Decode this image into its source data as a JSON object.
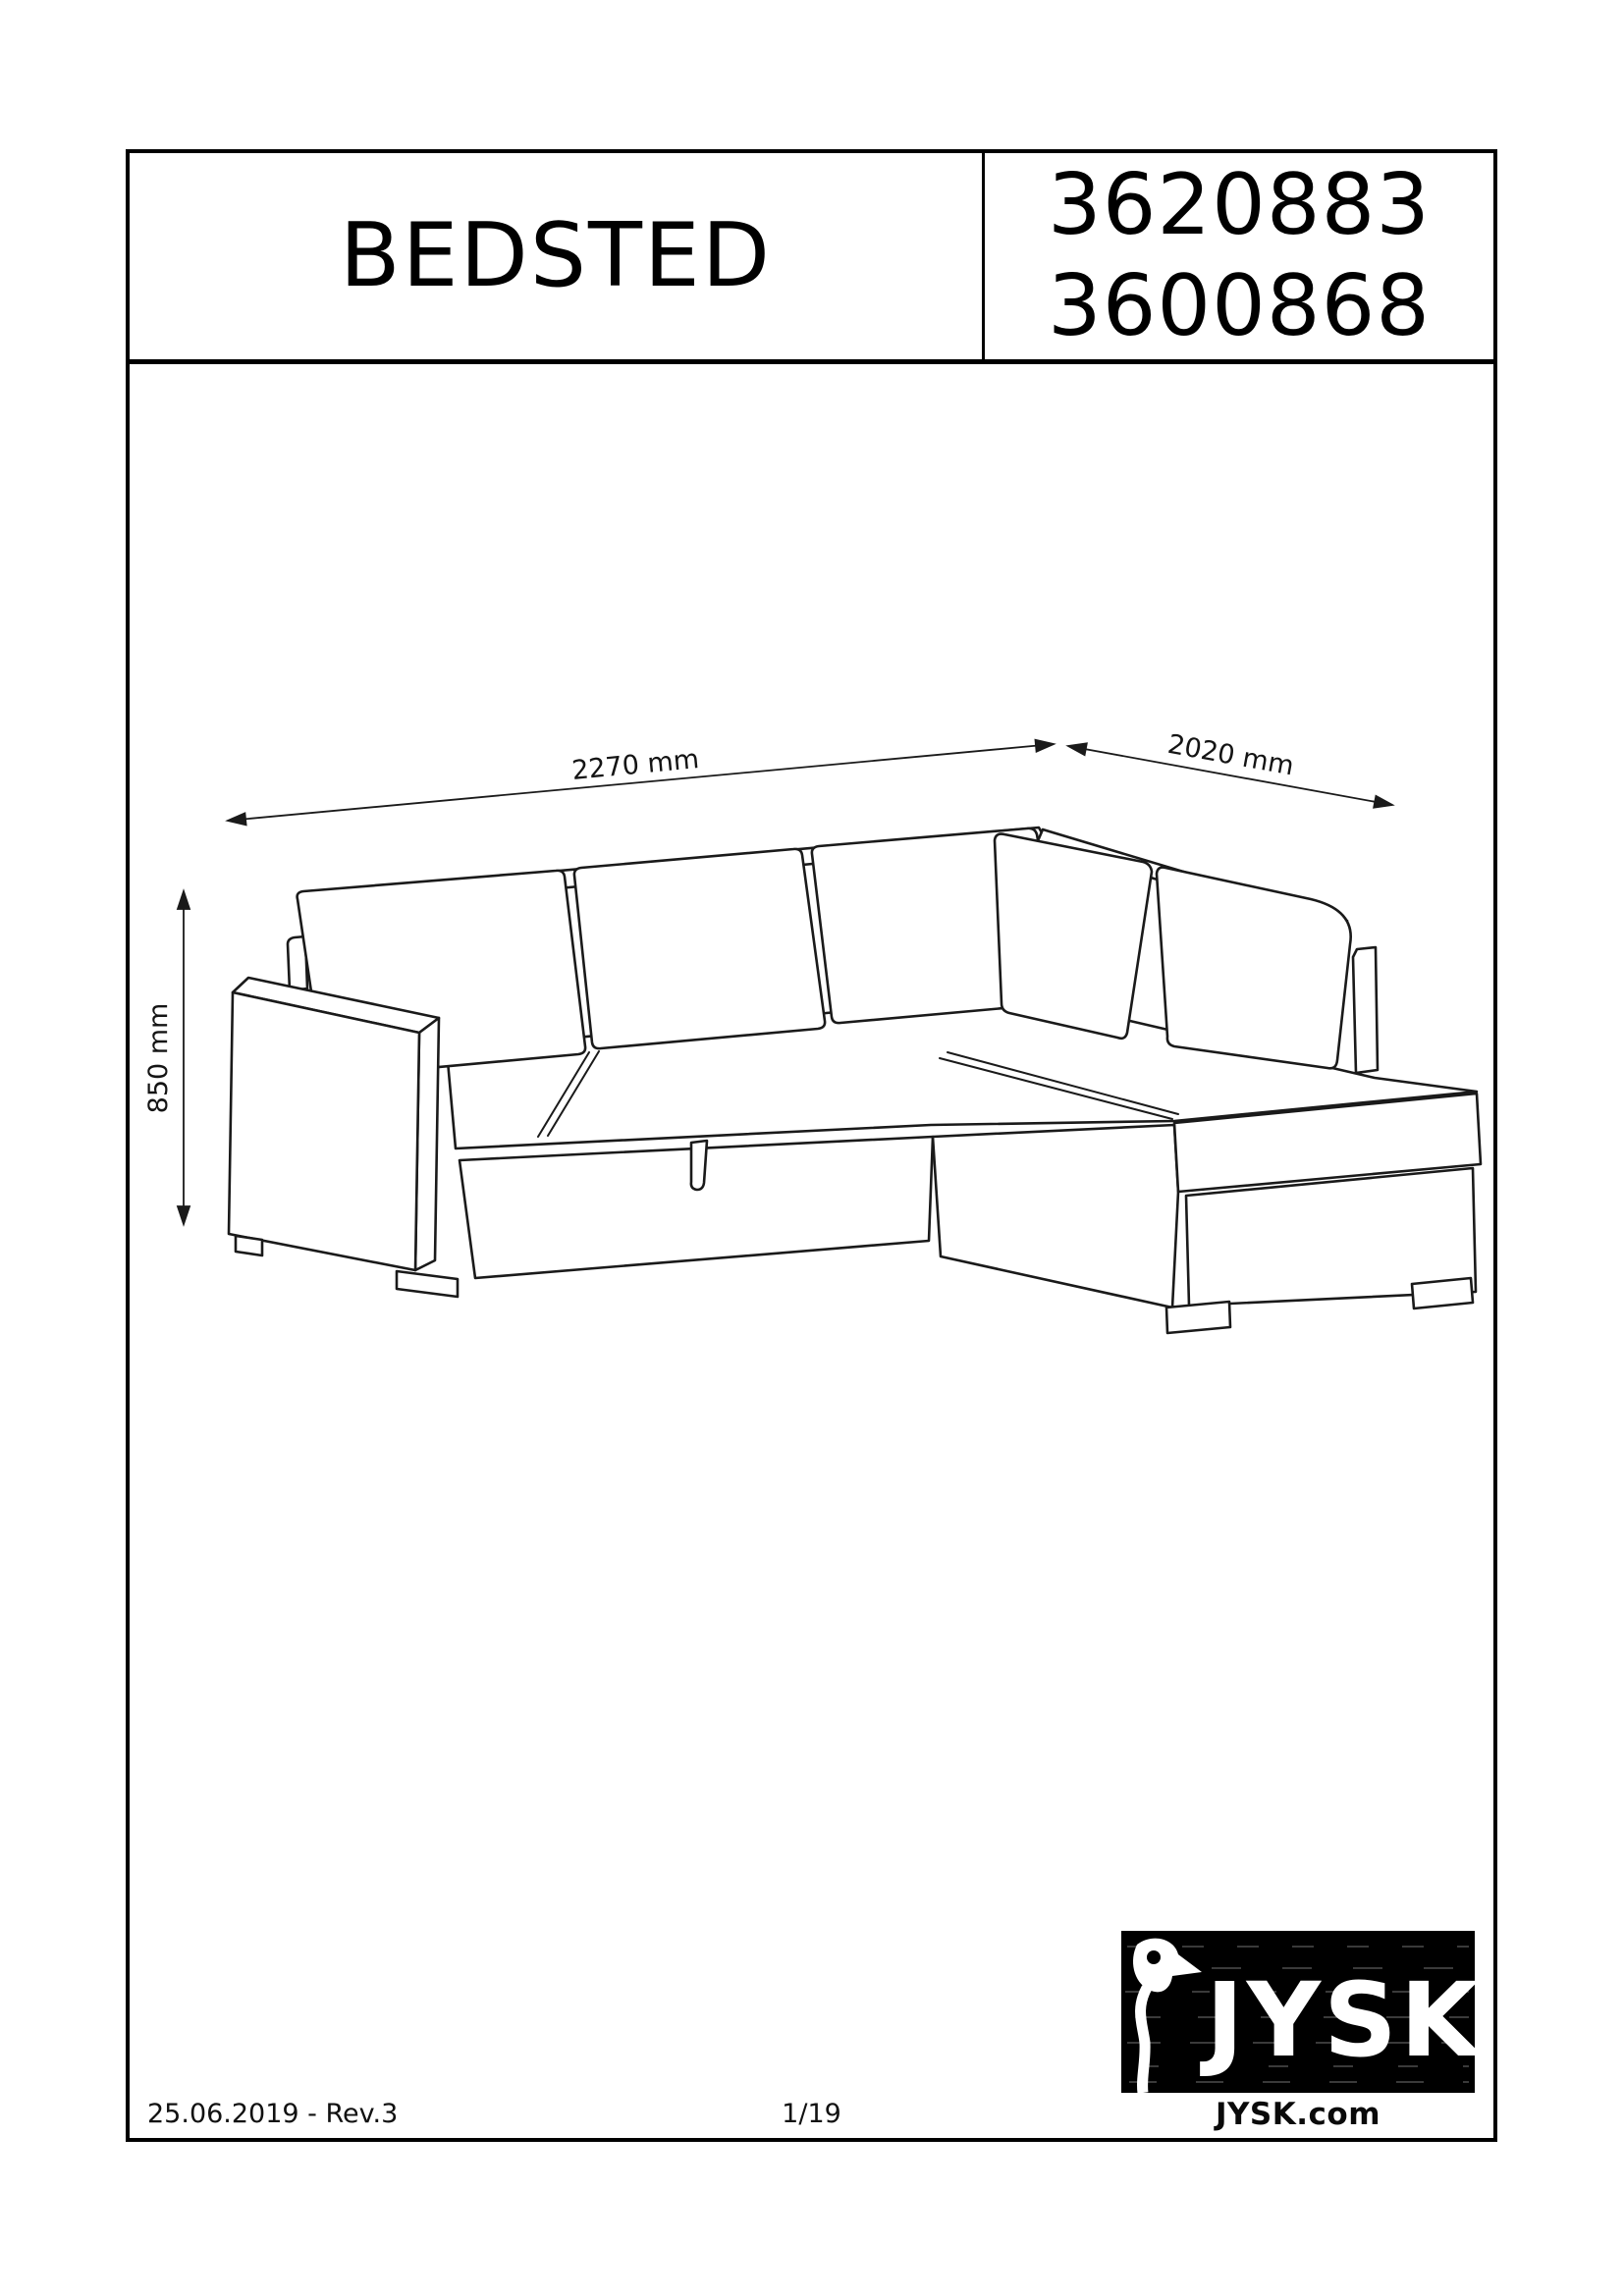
{
  "header": {
    "title": "BEDSTED",
    "code_line_1": "3620883",
    "code_line_2": "3600868"
  },
  "drawing": {
    "alt": "Isometric line drawing of a corner sofa bed with storage",
    "dimensions": {
      "width": "2270 mm",
      "depth": "2020 mm",
      "height": "850 mm"
    }
  },
  "footer": {
    "revision": "25.06.2019 - Rev.3",
    "page_number": "1/19",
    "website": "JYSK.com"
  },
  "logo": {
    "brand": "JYSK"
  },
  "colors": {
    "line": "#1a1a1a",
    "border": "#000000",
    "logo_bg": "#000000",
    "logo_fg": "#ffffff"
  }
}
